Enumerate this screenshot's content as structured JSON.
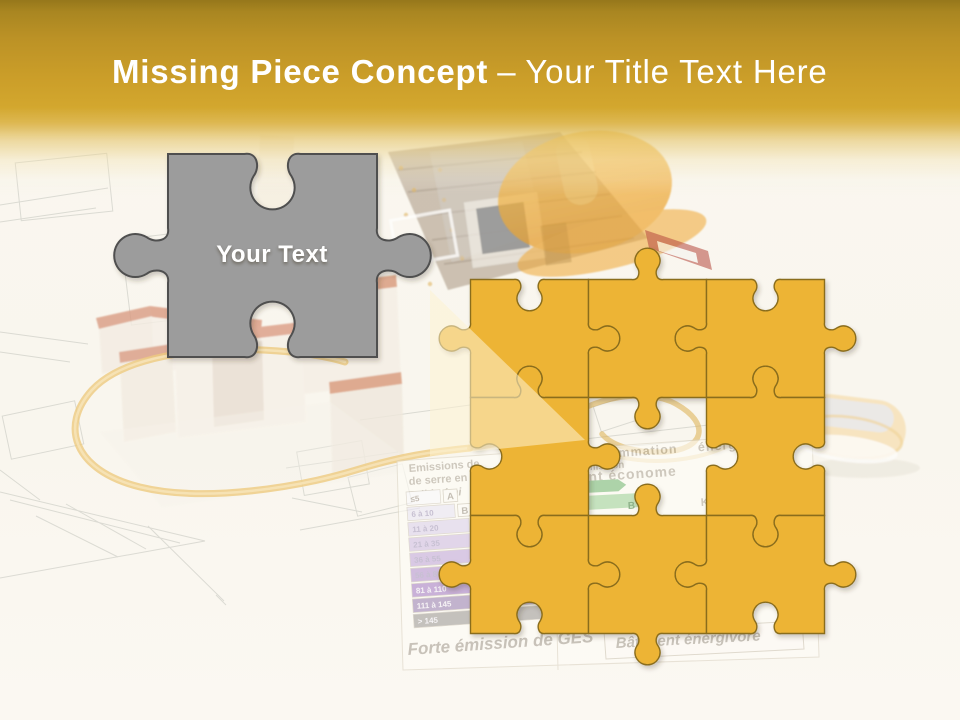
{
  "title": {
    "main": "Missing Piece Concept",
    "separator": "–",
    "secondary": "Your Title Text Here"
  },
  "gray_piece": {
    "label": "Your Text"
  },
  "puzzle_grid": {
    "rows": 3,
    "cols": 3,
    "missing_cell": "center",
    "visible_pieces": 8
  },
  "colors": {
    "header_gold": "#cb9e29",
    "header_gold_dark": "#96771b",
    "background_cream": "#f9f6ee",
    "puzzle_yellow": "#edb435",
    "puzzle_outline": "#8a6d1f",
    "gray_piece_fill": "#9c9c9c",
    "gray_piece_outline": "#4f4f4f",
    "title_text": "#ffffff",
    "beam_light": "rgba(253,243,210,0.55)"
  },
  "background": {
    "energy_label": {
      "header_lines": [
        "Emissions de",
        "de serre en",
        "Faible émi"
      ],
      "ges_rows": [
        {
          "range": "≤5",
          "class": "A",
          "color": "#fbfafd"
        },
        {
          "range": "6 à 10",
          "class": "B",
          "color": "#ebe7f5"
        },
        {
          "range": "11 à 20",
          "class": "C",
          "color": "#ded3ee"
        },
        {
          "range": "21 à 35",
          "class": "",
          "color": "#d2c0e6"
        },
        {
          "range": "36 à 55",
          "class": "",
          "color": "#c6addd"
        },
        {
          "range": "56 à 80",
          "class": "",
          "color": "#b999d4"
        },
        {
          "range": "81 à 110",
          "class": "",
          "color": "#ac86ca"
        },
        {
          "range": "111 à 145",
          "class": "",
          "color": "#a189b8"
        },
        {
          "range": "> 145",
          "class": "",
          "color": "#a3a19d"
        }
      ],
      "footer_left": "Forte émission de GES",
      "right_header": "Consommation énergétiques",
      "right_subline": "Wh emission",
      "right_building": "timent économe",
      "arrow_class_b": "B",
      "kwh_text": "KWh e",
      "footer_right": "Bâtiment énergivore"
    }
  }
}
